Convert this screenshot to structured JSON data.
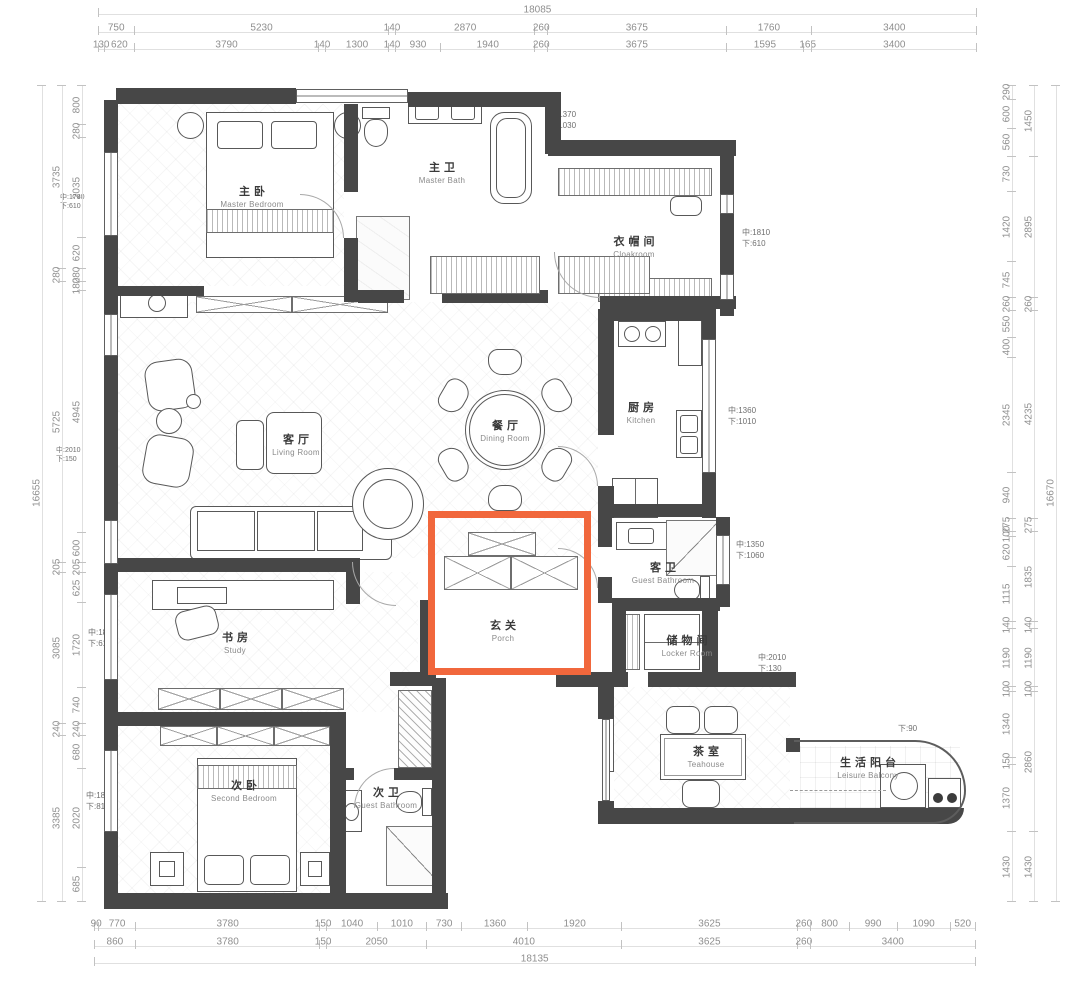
{
  "drawing": {
    "type": "apartment-floor-plan",
    "highlight_color": "#f1673c",
    "wall_color": "#474747",
    "dimension_text_color": "#8f8f8f"
  },
  "rooms": [
    {
      "id": "master-bedroom",
      "zh": "主卧",
      "en": "Master Bedroom"
    },
    {
      "id": "master-bath",
      "zh": "主卫",
      "en": "Master Bath"
    },
    {
      "id": "cloakroom",
      "zh": "衣帽间",
      "en": "Cloakroom"
    },
    {
      "id": "kitchen",
      "zh": "厨房",
      "en": "Kitchen"
    },
    {
      "id": "living-room",
      "zh": "客厅",
      "en": "Living Room"
    },
    {
      "id": "dining-room",
      "zh": "餐厅",
      "en": "Dining Room"
    },
    {
      "id": "porch",
      "zh": "玄关",
      "en": "Porch"
    },
    {
      "id": "guest-bathroom",
      "zh": "客卫",
      "en": "Guest Bathroom"
    },
    {
      "id": "locker-room",
      "zh": "储物间",
      "en": "Locker Room"
    },
    {
      "id": "study",
      "zh": "书房",
      "en": "Study"
    },
    {
      "id": "second-bedroom",
      "zh": "次卧",
      "en": "Second Bedroom"
    },
    {
      "id": "guest-bathroom-2",
      "zh": "次卫",
      "en": "Guest Bathroom"
    },
    {
      "id": "teahouse",
      "zh": "茶室",
      "en": "Teahouse"
    },
    {
      "id": "leisure-balcony",
      "zh": "生活阳台",
      "en": "Leisure Balcony"
    }
  ],
  "dimensions": {
    "top": {
      "overall": "18085",
      "row2": [
        "750",
        "5230",
        "140",
        "2870",
        "260",
        "3675",
        "1760",
        "3400"
      ],
      "row3": [
        "130",
        "620",
        "3790",
        "140",
        "1300",
        "140",
        "930",
        "1940",
        "260",
        "3675",
        "1595",
        "165",
        "3400"
      ]
    },
    "bottom": {
      "overall": "18135",
      "row1": [
        "90",
        "770",
        "3780",
        "150",
        "1040",
        "1010",
        "730",
        "1360",
        "1920",
        "3625",
        "260",
        "800",
        "990",
        "1090",
        "520"
      ],
      "row2": [
        "860",
        "3780",
        "150",
        "2050",
        "4010",
        "3625",
        "260",
        "3400"
      ]
    },
    "left": {
      "overall": "16655",
      "outer": [
        "3735",
        "280",
        "5725",
        "205",
        "3085",
        "240",
        "3385"
      ],
      "inner": [
        "800",
        "280",
        "2035",
        "620",
        "280",
        "180",
        "4945",
        "600",
        "205",
        "625",
        "1720",
        "740",
        "240",
        "680",
        "2020",
        "685"
      ]
    },
    "right": {
      "overall": "16670",
      "inner": [
        "290",
        "600",
        "560",
        "730",
        "1420",
        "745",
        "260",
        "550",
        "400",
        "2345",
        "940",
        "275",
        "100",
        "620",
        "1115",
        "140",
        "1190",
        "100",
        "1340",
        "150",
        "1370",
        "1430"
      ],
      "outer": [
        "1450",
        "2895",
        "260",
        "4235",
        "275",
        "1835",
        "140",
        "1190",
        "100",
        "2860",
        "1430"
      ]
    }
  },
  "annotations": [
    {
      "id": "win-master-left",
      "text": "中:1780\n下:610"
    },
    {
      "id": "win-living-left",
      "text": "中:2010\n下:150"
    },
    {
      "id": "win-study-left",
      "text": "中:1810\n下:610"
    },
    {
      "id": "win-bedroom2-left",
      "text": "中:1810\n下:810"
    },
    {
      "id": "win-masterbath-top",
      "text": "中:1370\n下:1030"
    },
    {
      "id": "win-cloakroom-right",
      "text": "中:1810\n下:610"
    },
    {
      "id": "win-kitchen-right",
      "text": "中:1360\n下:1010"
    },
    {
      "id": "win-guestbath-right",
      "text": "中:1350\n下:1060"
    },
    {
      "id": "win-locker-right",
      "text": "中:2010\n下:130"
    },
    {
      "id": "balcony-sill",
      "text": "下:90"
    }
  ]
}
